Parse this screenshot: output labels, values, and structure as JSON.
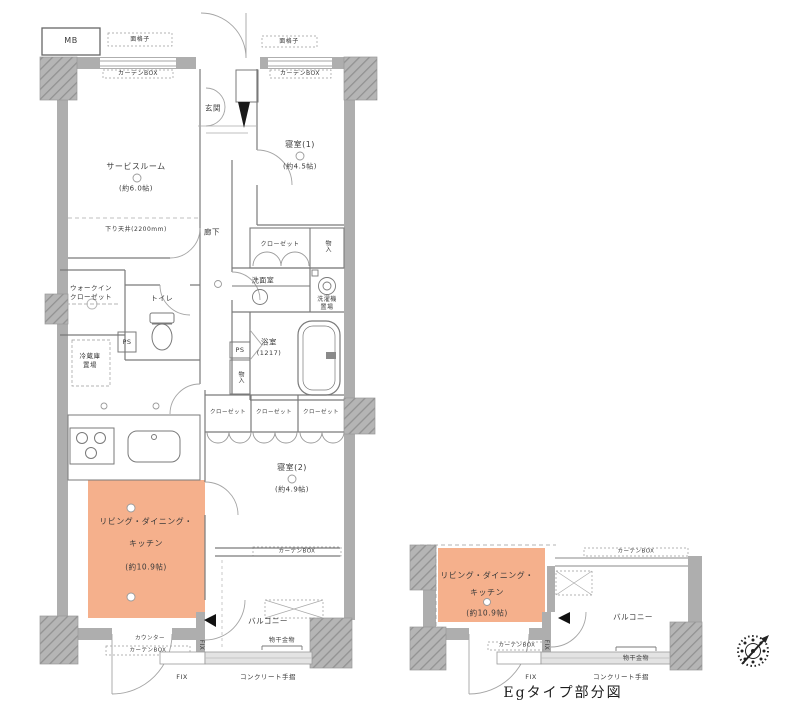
{
  "colors": {
    "ldk_fill": "#F5B08C",
    "wall": "#AEAEAE",
    "pillar": "#B5B5B5",
    "outline": "#7A7A7A",
    "rail": "#E3E3E3",
    "marker": "#111111",
    "text": "#3A3A3A"
  },
  "shared_labels": {
    "curtain_box": "カーテンBOX",
    "window_grille": "面格子",
    "closet": "クローゼット",
    "storage": "物入",
    "ps": "PS",
    "fix": "FIX",
    "concrete_handrail": "コンクリート手摺",
    "drying_fixture": "物干金物",
    "balcony": "バルコニー",
    "counter": "カウンター"
  },
  "main_plan": {
    "rooms": {
      "service_room": {
        "name": "サービスルーム",
        "size": "(約6.0帖)",
        "note": "下り天井(2200mm)"
      },
      "entrance": "玄関",
      "corridor": "廊下",
      "bedroom1": {
        "name": "寝室(1)",
        "size": "(約4.5帖)"
      },
      "bedroom2": {
        "name": "寝室(2)",
        "size": "(約4.9帖)"
      },
      "ldk": {
        "name_line1": "リビング・ダイニング・",
        "name_line2": "キッチン",
        "size": "(約10.9帖)"
      },
      "washroom": "洗面室",
      "bath": {
        "name": "浴室",
        "size": "(1217)"
      },
      "toilet": "トイレ",
      "wic": {
        "line1": "ウォークイン",
        "line2": "クローゼット"
      }
    },
    "labels": {
      "mb": "MB",
      "washer_line1": "洗濯機",
      "washer_line2": "置場",
      "fridge_line1": "冷蔵庫",
      "fridge_line2": "置場"
    }
  },
  "partial_plan": {
    "caption": "Egタイプ部分図",
    "ldk": {
      "name_line1": "リビング・ダイニング・",
      "name_line2": "キッチン",
      "size": "(約10.9帖)"
    }
  }
}
